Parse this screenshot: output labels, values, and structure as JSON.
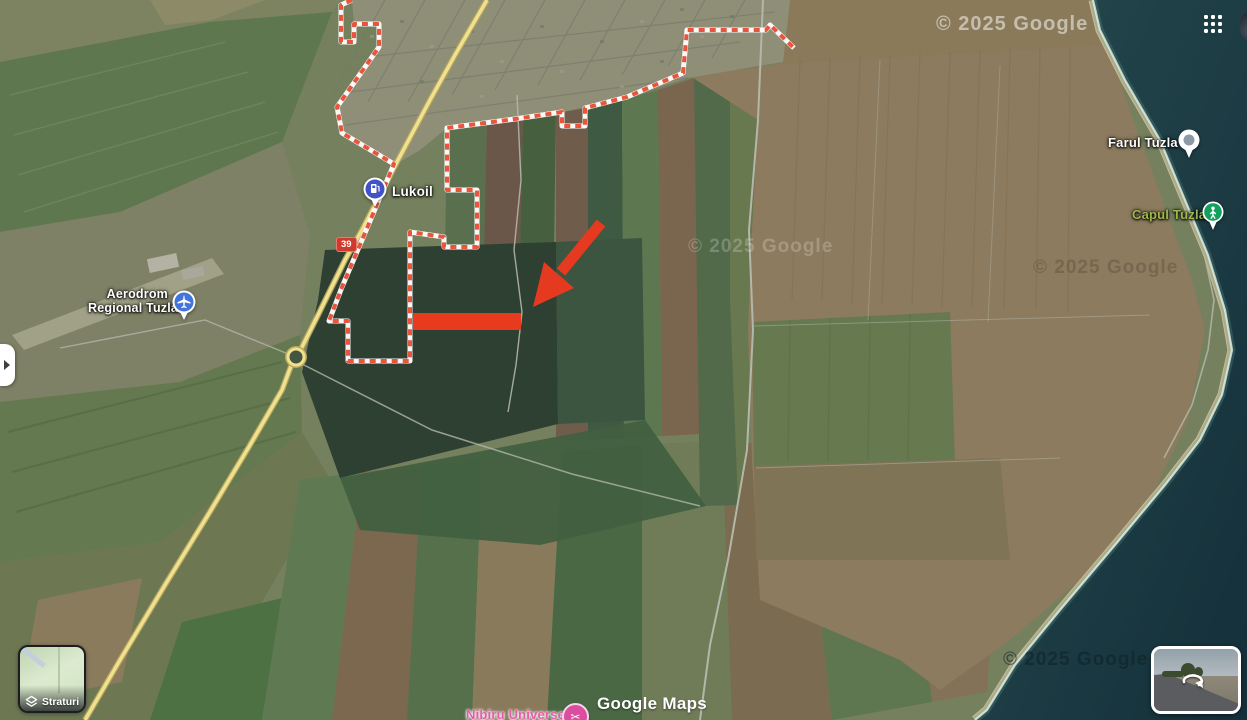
{
  "app": {
    "logo": "Google Maps"
  },
  "watermarks": {
    "sea_top": "© 2025 Google",
    "field_center": "© 2025 Google",
    "field_right": "© 2025 Google",
    "sea_bottom": "© 2025 Google"
  },
  "pois": {
    "airport": {
      "line1": "Aerodrom",
      "line2": "Regional Tuzla"
    },
    "gas_station": {
      "label": "Lukoil"
    },
    "lighthouse": {
      "label": "Farul Tuzla"
    },
    "cape": {
      "label": "Capul Tuzla"
    },
    "business": {
      "label": "Nibiru Universe"
    }
  },
  "roads": {
    "route_badge": "39"
  },
  "controls": {
    "layers_label": "Straturi"
  },
  "annotation": {
    "type": "arrow-and-highlight-rectangle",
    "arrow_color": "#e63a20",
    "highlight_color": "#e83a1c"
  },
  "colors": {
    "boundary_dash_red": "#e8543c",
    "road_yellow": "#efe18e",
    "sea_teal": "#1e3b40",
    "poi_pin_blue": "#4254c5",
    "cape_pin_green": "#12a05c",
    "cape_label_green": "#9cb84d",
    "business_pink": "#db4d9e"
  }
}
